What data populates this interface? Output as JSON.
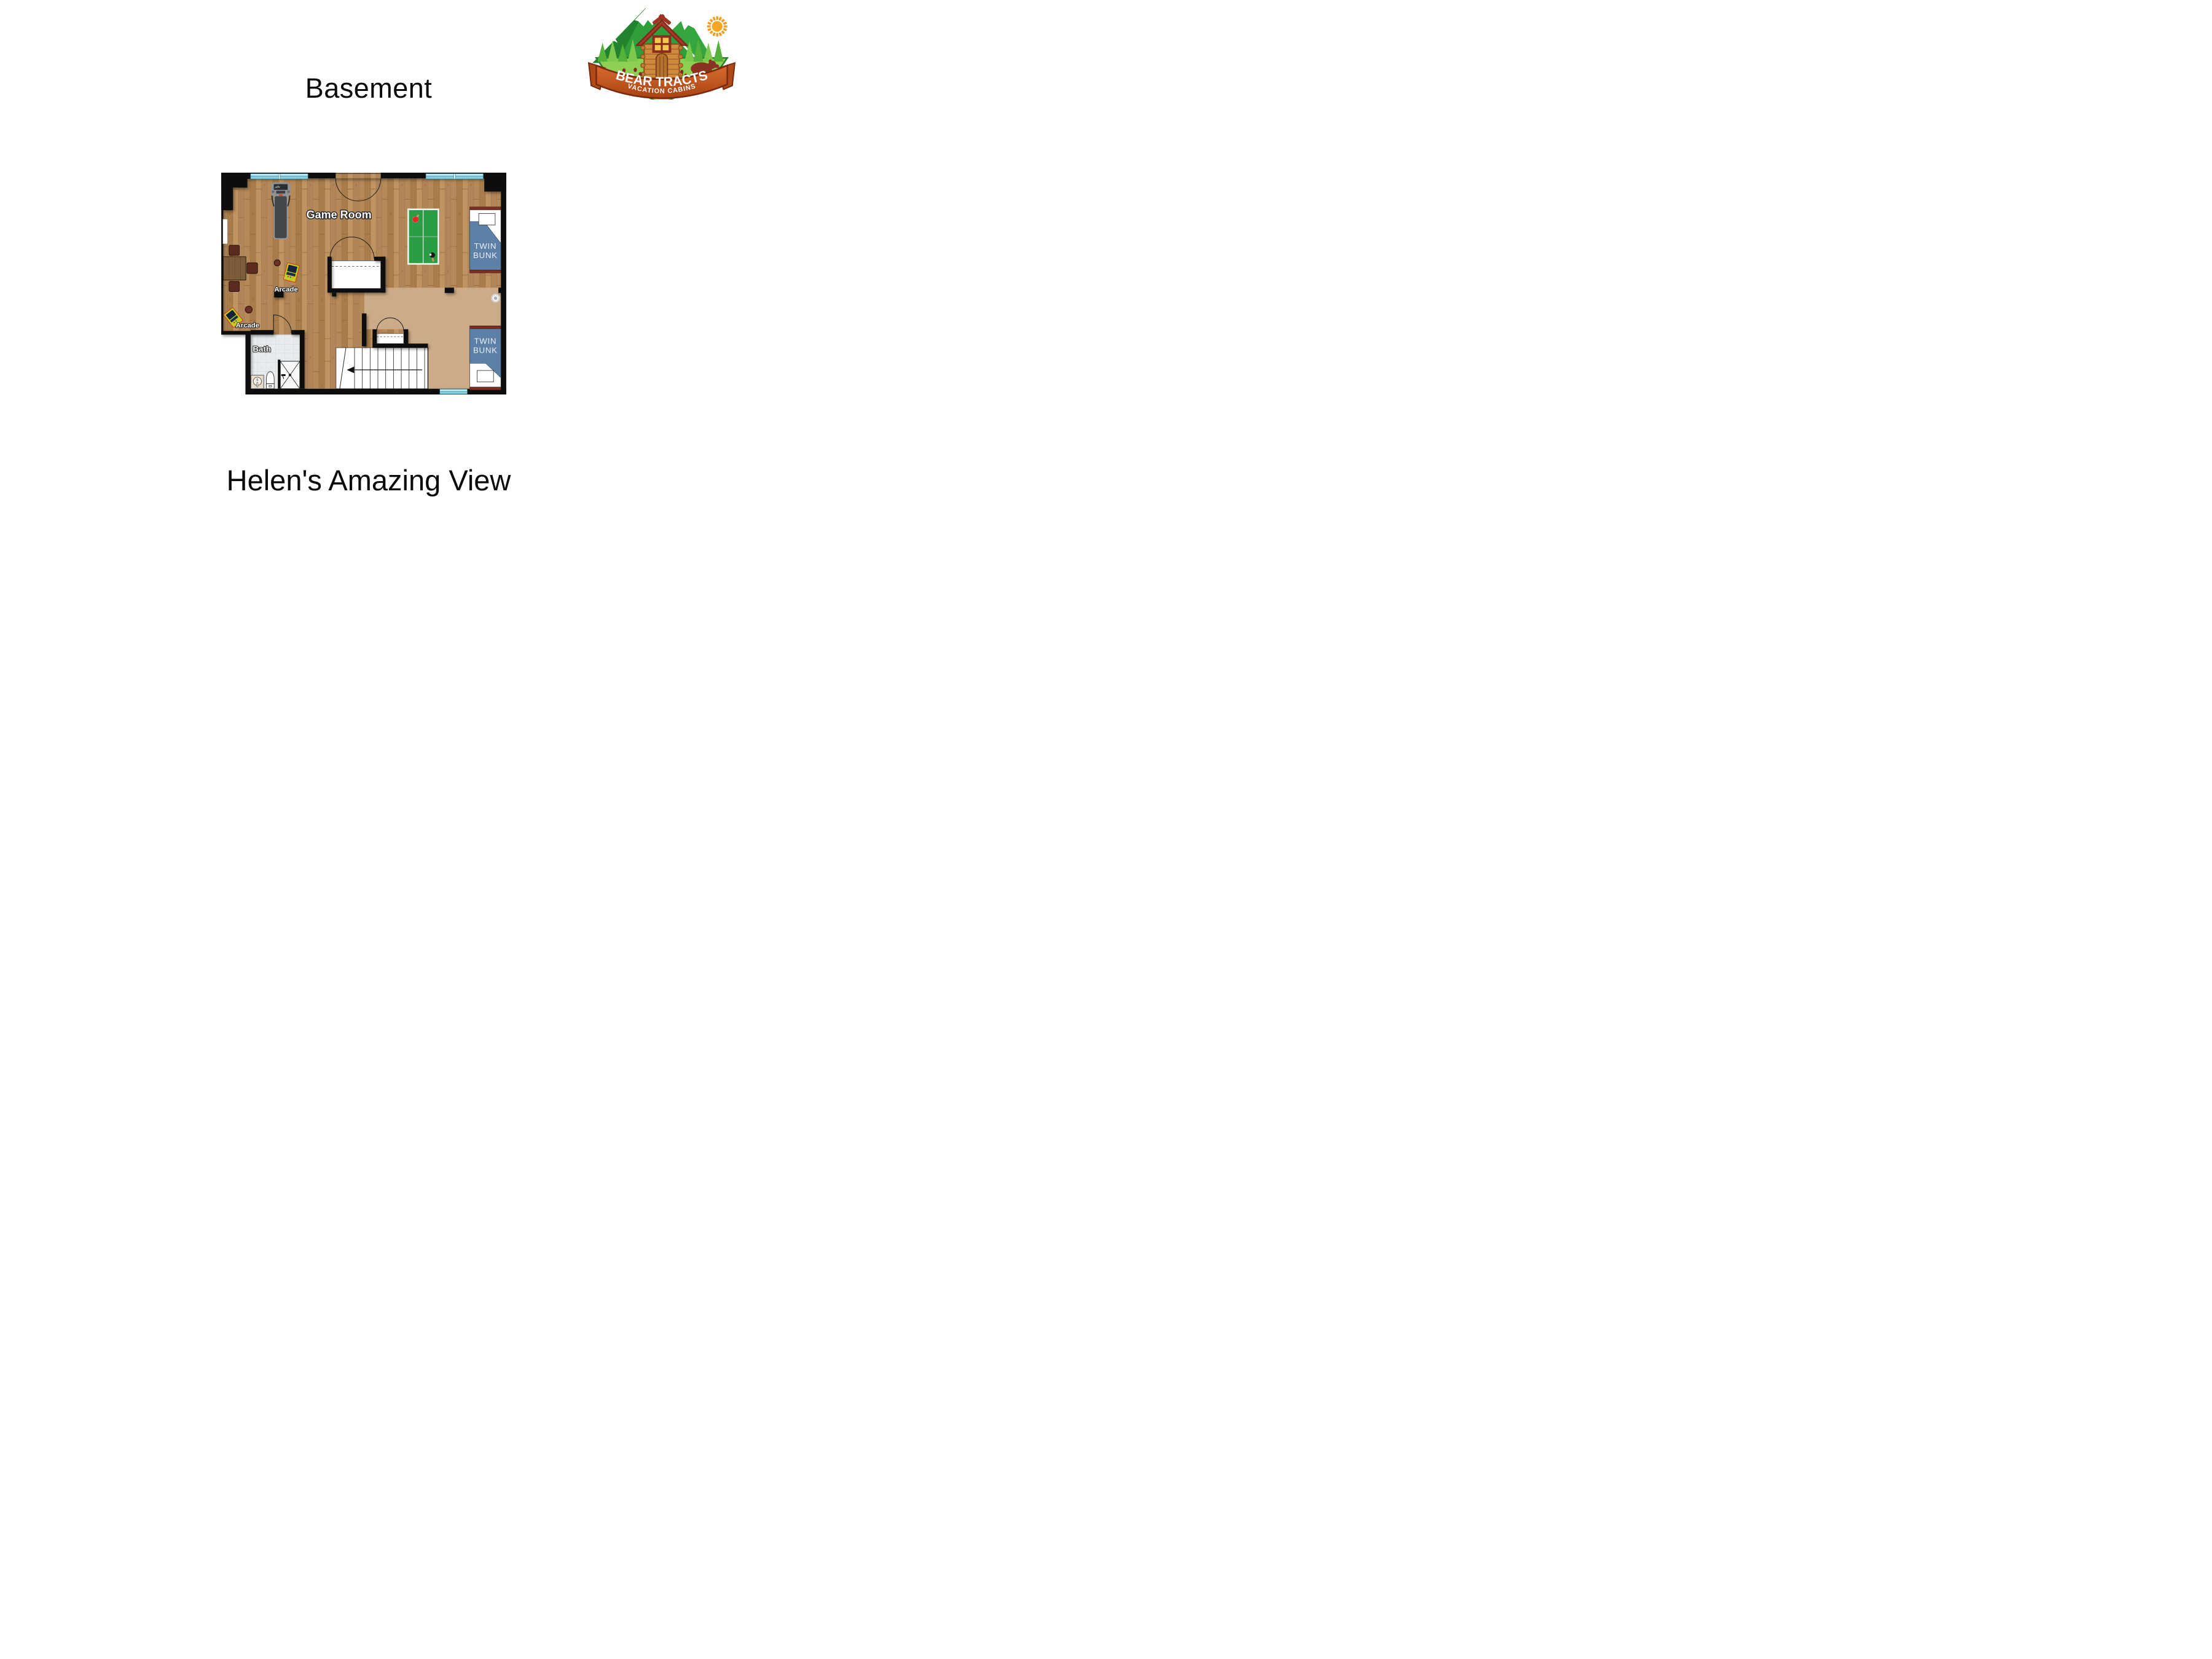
{
  "header": {
    "title": "Basement"
  },
  "footer": {
    "subtitle": "Helen's Amazing View"
  },
  "logo": {
    "name": "Bear Tracts Vacation Cabins",
    "line1": "BEAR TRACTS",
    "line2": "VACATION CABINS"
  },
  "floorplan": {
    "labels": {
      "game_room": "Game Room",
      "bath": "Bath",
      "arcade": "Arcade",
      "twin_line1": "TWIN",
      "twin_line2": "BUNK"
    },
    "rooms": [
      {
        "name": "Game Room",
        "floor": "wood"
      },
      {
        "name": "Bath",
        "floor": "tile"
      },
      {
        "name": "Bunk room",
        "floor": "carpet"
      }
    ],
    "objects": [
      "treadmill",
      "ping-pong-table",
      "arcade-cabinet",
      "arcade-cabinet",
      "game-table-with-stools",
      "twin-bunk-bed",
      "twin-bunk-bed",
      "double-door-closet",
      "double-door-closet",
      "stairs-down-arrow",
      "shower",
      "toilet",
      "sink-vanity",
      "ceiling-speaker",
      "window",
      "window",
      "window"
    ],
    "colors": {
      "wall": "#0b0b0b",
      "wood": "#b1855a",
      "carpet": "#cdab86",
      "tile": "#e9ecee",
      "window": "#aee4f0",
      "pingpong_green": "#2a9d45",
      "bed_blue": "#5d80a6",
      "bed_trim": "#7b2d22",
      "arcade_yellow": "#c3cf1e",
      "stool_brown": "#5c2b1f",
      "logo_green": "#2f9e3b",
      "logo_ribbon": "#d96a2e",
      "logo_sun": "#f59d20"
    }
  }
}
